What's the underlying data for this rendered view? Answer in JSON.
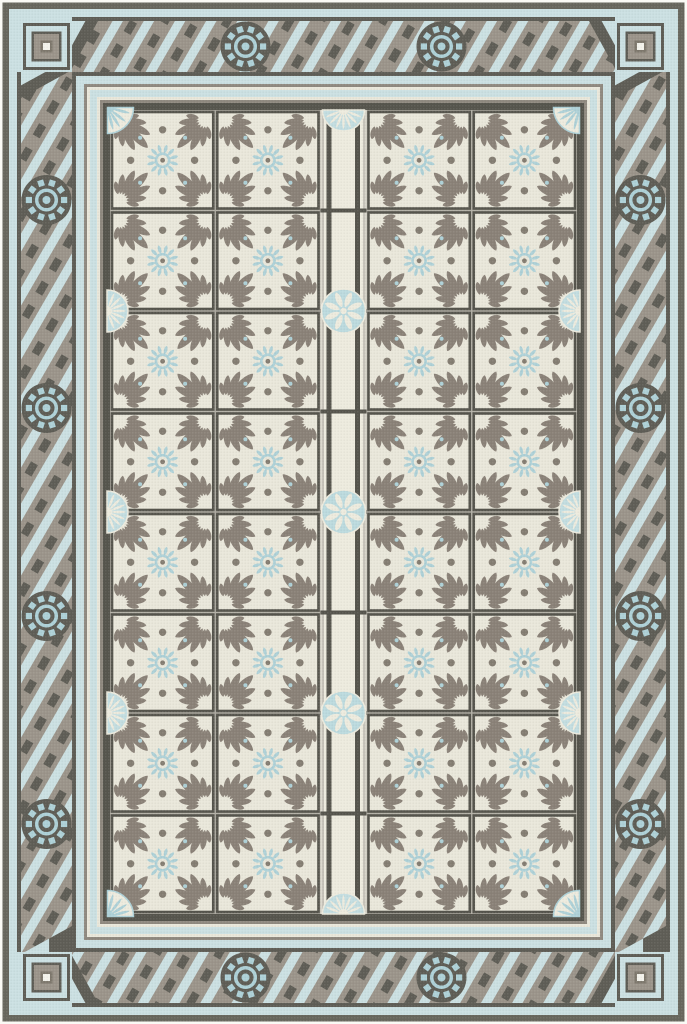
{
  "image": {
    "type": "product-photo",
    "subject": "rectangular vinyl floor mat with vintage encaustic tile pattern",
    "width_px": 687,
    "height_px": 1024
  },
  "palette": {
    "page_bg": "#ffffff",
    "mat_edge_white": "#fafaf5",
    "outer_dark": "#67665d",
    "pale_blue": "#cbe0e2",
    "taupe": "#9b948a",
    "band_dark": "#5e5d55",
    "frame_dark": "#55544c",
    "cream": "#e9e7da",
    "strip_cream": "#edebde",
    "gap_gray": "#b2afa5",
    "motif_gray": "#8a8177",
    "dot_gray": "#847d72",
    "blue_mid": "#aed1d7",
    "fan_blue": "#c3dde0",
    "rosette_blue": "#bcdade",
    "mid_gray_line": "#8f897f",
    "center_white": "#f4f3ec"
  },
  "design": {
    "field": {
      "rows": 8,
      "columns": 4,
      "tile_count": 32,
      "tile_motif": "four gray palmette leaf fans with light-blue center rosette and gray dots",
      "center_strip": {
        "rosette_count": 3,
        "end_fan_count": 2
      }
    },
    "inner_frame": {
      "corner_fan_count": 4,
      "edge_fan_count": 6,
      "style": "blue and cream pinstripes"
    },
    "outer_border": {
      "style": "diagonal rope stripes on taupe",
      "medallions": {
        "top": 2,
        "bottom": 2,
        "left": 4,
        "right": 4
      },
      "medallion_motif": "dark circle with light-blue gear sun",
      "corner_squares": 4,
      "corner_square_motif": "concentric dark, blue and taupe squares with white center"
    }
  }
}
